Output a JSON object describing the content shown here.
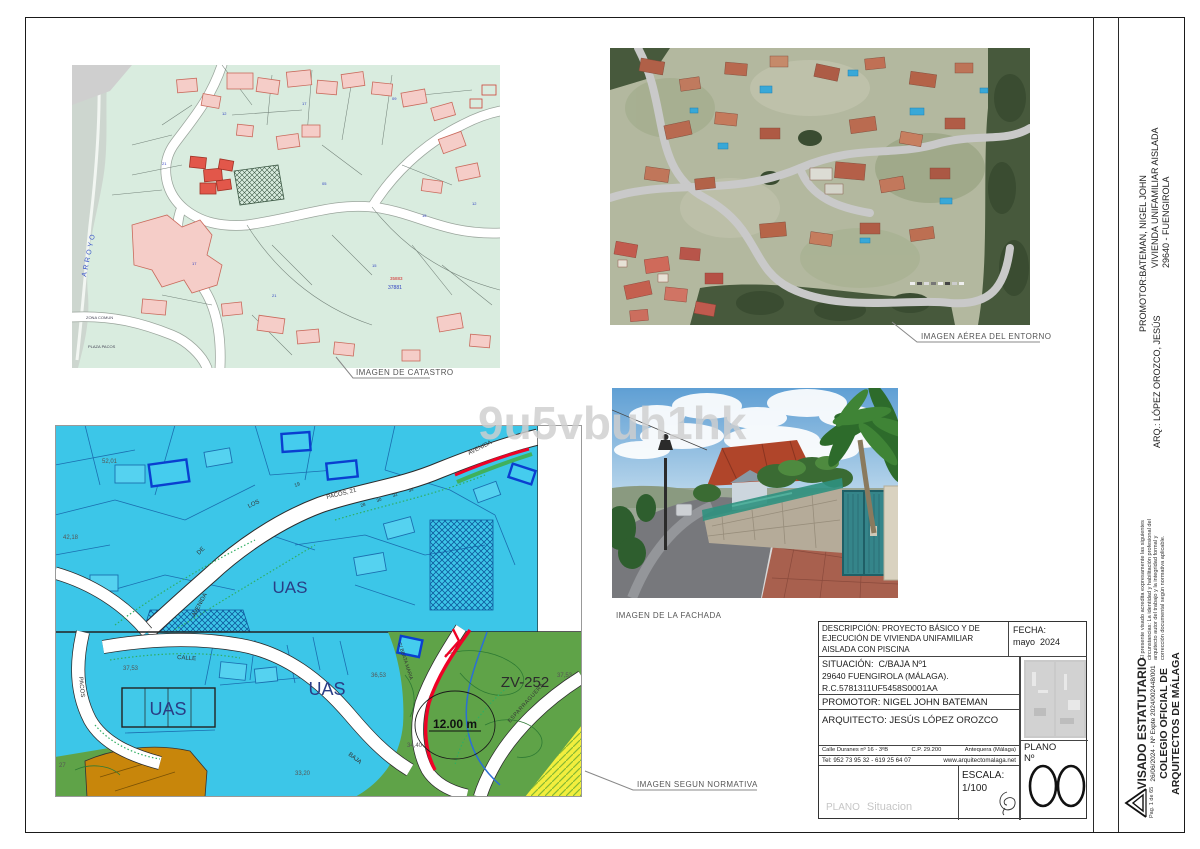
{
  "watermark": "9u5vbuh1hk",
  "captions": {
    "catastro": "IMAGEN DE CATASTRO",
    "aerea": "IMAGEN AÉREA DEL ENTORNO",
    "fachada": "IMAGEN DE LA FACHADA",
    "normativa": "IMAGEN SEGUN NORMATIVA"
  },
  "catastro": {
    "arroyo": "ARROYO",
    "zona_comun": "ZONA COMUN",
    "plaza_pacos": "PLAZA PACOS",
    "ref_red": "35883",
    "ref_blue": "37881",
    "n1": "12",
    "n2": "17",
    "n3": "09",
    "n4": "21",
    "n5": "05",
    "n6": "15"
  },
  "normativa": {
    "uas": "UAS",
    "zv": "ZV-252",
    "dim": "12.00 m",
    "avenida": "AVENIDA",
    "de": "DE",
    "los": "LOS",
    "pacos21": "PACOS, 21",
    "pacos": "PACOS",
    "calle": "CALLE",
    "baja": "BAJA",
    "esparraguera": "ESPARRAGUERA",
    "beata": "C/ BEATA MARIA",
    "n19": "19",
    "n28": "28",
    "n30": "30",
    "n32": "32",
    "n34": "34",
    "v5201": "52,01",
    "v4218": "42,18",
    "v3753": "37,53",
    "v3653": "36,53",
    "v3440": "34,40",
    "v3320": "33,20",
    "v27": "27",
    "v3753b": "37,53"
  },
  "titleblock": {
    "descripcion_label": "DESCRIPCIÓN:",
    "descripcion_l1": "PROYECTO BÁSICO Y DE",
    "descripcion_l2": "EJECUCIÓN DE VIVIENDA UNIFAMILIAR",
    "descripcion_l3": "AISLADA CON PISCINA",
    "fecha_label": "FECHA:",
    "fecha_value": "mayo  2024",
    "situacion_l1": "SITUACIÓN:  C/BAJA Nº1",
    "situacion_l2": "29640 FUENGIROLA (MÁLAGA).",
    "situacion_l3": "R.C.5781311UF5458S0001AA",
    "promotor": "PROMOTOR: NIGEL JOHN BATEMAN",
    "arquitecto": "ARQUITECTO: JESÚS LÓPEZ OROZCO",
    "addr1": "Calle Duranes nº 16 - 3ºB",
    "addr2": "C.P. 29.200",
    "addr3": "Antequera (Málaga)",
    "tel": "Tel: 952 73 95 32 - 619 25 64 07",
    "web": "www.arquitectomalaga.net",
    "plano_label": "PLANO",
    "plano_no": "Nº",
    "plano_num": "00",
    "escala_label": "ESCALA:",
    "escala_value": "1/100",
    "plano_name_label": "PLANO",
    "plano_name_value": "Situacion"
  },
  "sidebar": {
    "promotor_label": "PROMOTOR:",
    "promotor_l1": "BATEMAN, NIGEL JOHN",
    "promotor_l2": "VIVIENDA UNIFAMILIAR AISLADA",
    "promotor_l3": "29640 - FUENGIROLA",
    "arquitecto": "ARQ.: LÓPEZ OROZCO, JESÚS",
    "note_l1": "El presente visado acredita expresamente las siguientes",
    "note_l2": "circunstancias: La identidad y habilitación profesional del",
    "note_l3": "arquitecto autor del trabajo y la integridad formal y",
    "note_l4": "corrección documental según normativa aplicable.",
    "visado_l1": "VISADO ESTATUTARIO",
    "visado_l2": "26/06/2024 - Nº Expte 2024/002448/001",
    "visado_l3": "COLEGIO OFICIAL DE",
    "visado_l4": "ARQUITECTOS DE MÁLAGA",
    "page": "Pag. 1 de 65"
  },
  "colors": {
    "cyan_zone": "#3cc6e8",
    "green_zone": "#5fa348",
    "plot_red": "#ef0226",
    "pool_blue": "#0a3fd0",
    "orange_zone": "#c8860b",
    "yellow_zone": "#f2ee3e"
  }
}
